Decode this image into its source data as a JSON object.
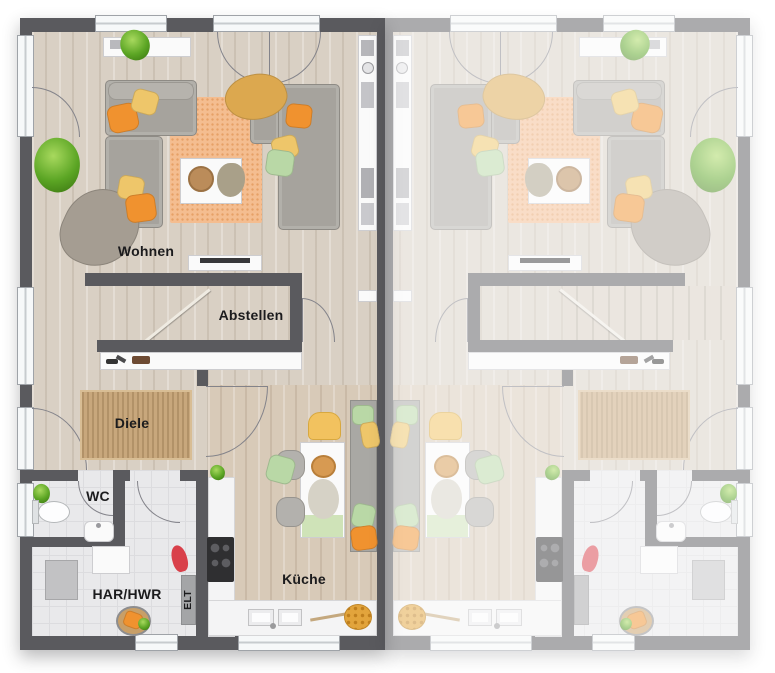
{
  "plan": {
    "left_unit": "furnished unit (color)",
    "right_unit": "mirrored neighbour unit (faded)"
  },
  "labels": {
    "wohnen": "Wohnen",
    "abstellen": "Abstellen",
    "diele": "Diele",
    "wc": "WC",
    "har_hwr": "HAR/HWR",
    "elt": "ELT",
    "kueche": "Küche"
  },
  "colors": {
    "wall": "#5a5a5e",
    "floor_wood": "#d9d0c4",
    "floor_wood_kitchen": "#d8cab8",
    "floor_tile": "#e9e9eb",
    "rug_living": "#f4bd90",
    "rug_hall": "#c8a77c",
    "sofa": "#a6a39d",
    "pillow_orange": "#f0922f",
    "pillow_yellow": "#eec66a",
    "pillow_green": "#b9d8a6",
    "throw_mustard": "#dca84f",
    "chair_yellow": "#f2c25f",
    "bench_green": "#cfe3b8",
    "plant_green": "#5ba524",
    "vacuum_red": "#d9404a"
  }
}
